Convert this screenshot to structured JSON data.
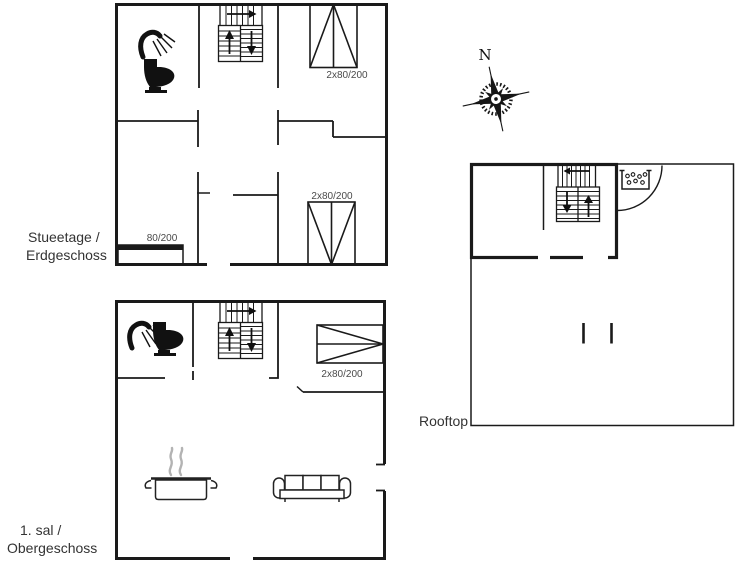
{
  "compass": {
    "north_label": "N"
  },
  "floors": {
    "ground": {
      "name_line1": "Stueetage /",
      "name_line2": "Erdgeschoss",
      "bed_top_label": "2x80/200",
      "bed_bottom_label": "2x80/200",
      "single_bed_label": "80/200"
    },
    "first": {
      "name_line1": "1. sal /",
      "name_line2": "Obergeschoss",
      "bed_label": "2x80/200"
    },
    "rooftop": {
      "name": "Rooftop"
    }
  },
  "icons": {
    "shower": "shower-icon",
    "toilet": "toilet-icon",
    "stairs": "stairs-icon",
    "double_bed": "double-bed-icon",
    "single_bed": "single-bed-icon",
    "cooking_pot": "cooking-pot-icon",
    "sofa": "sofa-icon",
    "grill": "grill-icon",
    "door_swing": "door-swing-arc",
    "compass_rose": "compass-rose-icon"
  },
  "colors": {
    "wall": "#1a1a1a",
    "label_text": "#333333",
    "dimension_text": "#4a4a4a",
    "steam": "#b3b3b3",
    "background": "#ffffff"
  }
}
